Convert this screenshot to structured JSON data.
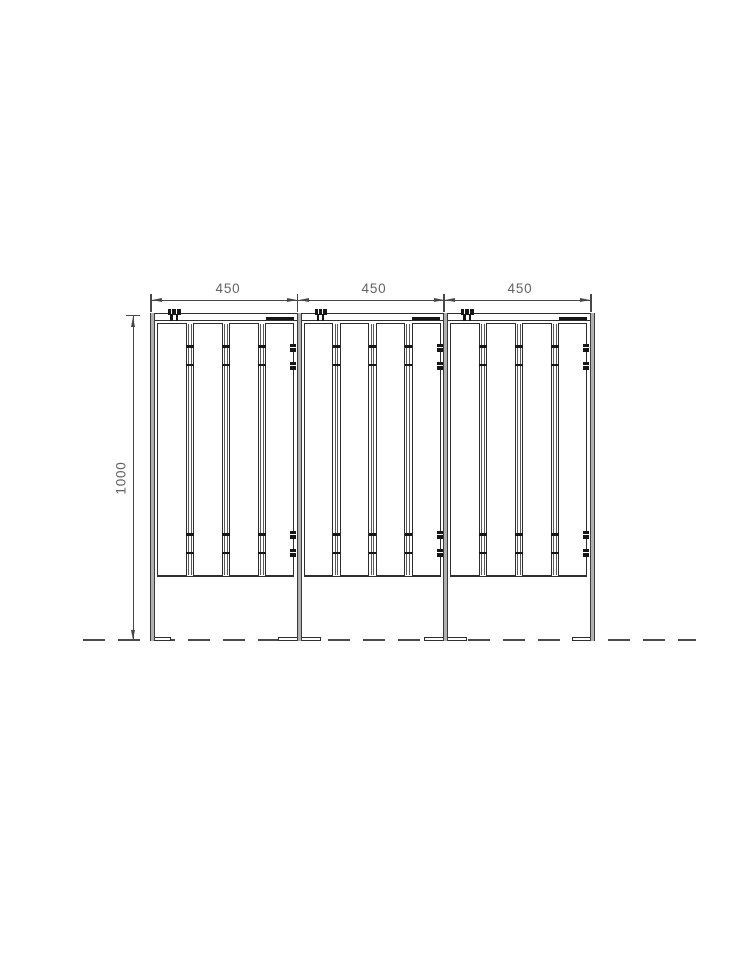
{
  "drawing": {
    "type": "technical-elevation",
    "description": "Three-panel slatted fence screen, front elevation with CAD dimensions",
    "dimensions": {
      "horizontal": [
        "450",
        "450",
        "450"
      ],
      "vertical": "1000"
    },
    "structure": {
      "panel_count": 3,
      "slats_per_panel": 4,
      "post_count": 4,
      "clip_pairs_per_post": 2,
      "clamp_per_panel": 1
    },
    "colors": {
      "line": "#2e2e2e",
      "dim_line": "#474747",
      "dim_text": "#636363",
      "post_fill": "#b0b0b0",
      "hardware": "#161616",
      "ground": "#4a4a4a",
      "background": "#ffffff"
    }
  }
}
